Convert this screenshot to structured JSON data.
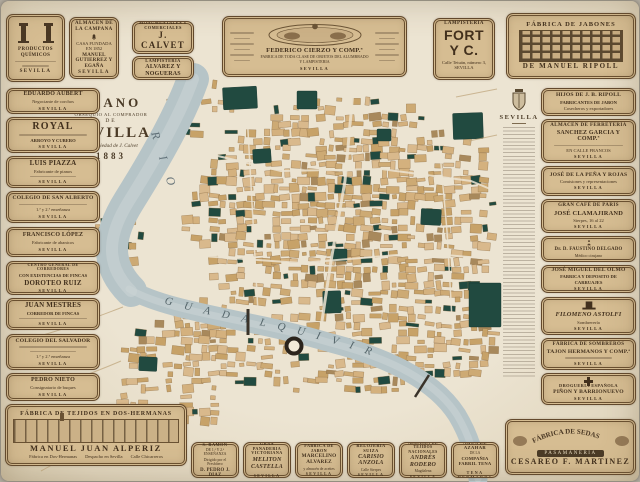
{
  "palette": {
    "paper": "#ece4d2",
    "ad_bg": "#d6bd92",
    "ad_border": "#63492c",
    "ink": "#42301d",
    "river": "#b6c4c7",
    "block_tan": "#d3b07d",
    "landmark_green": "#214a40"
  },
  "title_block": {
    "kicker": "PLANO",
    "dedication": "OBSEQUIO AL COMPRADOR",
    "de": "DE",
    "city": "SEVILLA",
    "property": "Es propiedad de J. Calvet",
    "year": "1883"
  },
  "map_labels": {
    "rio": "RIO",
    "river": "GUADALQUIVIR"
  },
  "strip": {
    "heading": "SEVILLA"
  },
  "top_ads": [
    {
      "header": "PRODUCTOS QUÍMICOS",
      "city": "SEVILLA"
    },
    {
      "header": "ALMACEN DE LA CAMPANA",
      "line": "CASA FUNDADA EN 1852",
      "name": "MANUEL GUTIERREZ Y EGAÑA",
      "city": "SEVILLA"
    },
    {
      "header": "PLANOS MONUMENTALES Y COMERCIALES",
      "name": "J. CALVET",
      "city": "BARCELONA"
    },
    {
      "header": "TALLER DE LAMPISTERIA",
      "name": "ALVAREZ Y NOGUERAS",
      "line": "Calle de Gallegos",
      "city": "SEVILLA"
    },
    {
      "name": "FEDERICO CIERZO Y COMP.ª",
      "sub": "FABRICA DE TODA CLASE DE OBJETOS DEL ALUMBRADO Y LAMPISTERIA",
      "city": "SEVILLA"
    },
    {
      "header": "LAMPISTERIA",
      "name": "FORT Y C.",
      "line": "Calle Tetuán, número 3, SEVILLA"
    },
    {
      "header": "FÁBRICA DE JABONES",
      "name": "DE MANUEL RIPOLL",
      "city": "SEVILLA"
    }
  ],
  "left_ads": [
    {
      "name": "EDUARDO AUBERT",
      "line": "Negociante de corchos",
      "city": "SEVILLA"
    },
    {
      "name": "ROYAL",
      "line": "ARROYO Y CUBERO",
      "city": "SEVILLA"
    },
    {
      "name": "LUIS PIAZZA",
      "line": "Fabricante de pianos",
      "city": "SEVILLA"
    },
    {
      "name": "COLEGIO DE SAN ALBERTO",
      "line": "1.ª y 2.ª enseñanza",
      "city": "SEVILLA"
    },
    {
      "name": "FRANCISCO LÓPEZ",
      "line": "Fabricante de abanicos",
      "city": "SEVILLA"
    },
    {
      "header": "CENTRO GENERAL DE CORREDORES",
      "sub": "CON EXISTENCIAS DE FINCAS",
      "name": "DOROTEO RUIZ",
      "city": "SEVILLA"
    },
    {
      "name": "JUAN MESTRES",
      "sub": "CORREDOR DE FINCAS",
      "city": "SEVILLA"
    },
    {
      "name": "COLEGIO DEL SALVADOR",
      "line": "1.ª y 2.ª enseñanza",
      "city": "SEVILLA"
    },
    {
      "name": "PEDRO NIETO",
      "line": "Consignatario de buques",
      "city": "SEVILLA"
    }
  ],
  "tejidos_ad": {
    "header": "FÁBRICA DE TEJIDOS EN DOS-HERMANAS",
    "name": "MANUEL JUAN ALPERIZ",
    "foot_left": "Fábrica en Dos-Hermanas",
    "foot_center": "Despacho en Sevilla",
    "foot_right": "Calle Chicarreros"
  },
  "right_ads": [
    {
      "name": "HIJOS DE J. B. RIPOLL",
      "sub": "FABRICANTES DE JABON",
      "line": "Cosecheros y exportadores",
      "city": "SEVILLA"
    },
    {
      "header": "ALMACEN DE FERRETERIA",
      "name": "SANCHEZ GARCIA Y COMP.ª",
      "line": "EN CALLE FRANCOS",
      "city": "SEVILLA"
    },
    {
      "name": "JOSÉ DE LA PEÑA Y ROJAS",
      "line": "Comisiones y representaciones",
      "city": "SEVILLA"
    },
    {
      "header": "GRAN CAFÉ DE PARIS",
      "name": "JOSÉ CLAMAJIRAND",
      "line": "Sierpes, 16 al 22",
      "city": "SEVILLA"
    },
    {
      "name": "Dr. D. FAUSTINO DELGADO",
      "line": "Médico cirujano",
      "city": "SEVILLA"
    },
    {
      "name": "JOSÉ MIGUEL DEL OLMO",
      "sub": "FABRICA Y DEPOSITO DE CARRUAJES",
      "city": "SEVILLA"
    },
    {
      "name": "FILOMENO ASTOLFI",
      "line": "Sombrerería",
      "city": "SEVILLA"
    },
    {
      "header": "FÁBRICA DE SOMBREROS",
      "name": "TAJON HERMANOS Y COMP.ª",
      "city": "SEVILLA"
    },
    {
      "header": "DROGUERIA ESPAÑOLA",
      "name": "PIÑON Y BARRIONUEVO",
      "city": "SEVILLA"
    }
  ],
  "bottom_ads": [
    {
      "header": "COLEGIO DE S. RAMON",
      "line": "DE 1.ª Y 2.ª ENSEÑANZA",
      "line2": "Dirigido por el Presbítero",
      "name": "D. PEDRO J. DIAZ",
      "city": "SEVILLA"
    },
    {
      "header": "GRAN PANADERIA VICTORIANA",
      "name": "MELITON CASTELLA",
      "city": "SEVILLA"
    },
    {
      "header": "FABRICA DE JABON",
      "name": "MARCELINO ALVAREZ",
      "line": "y almacén de aceites",
      "city": "SEVILLA"
    },
    {
      "header": "RELOJERIA SUIZA",
      "name": "CARISIO ANZOLA",
      "line": "Calle Sierpes",
      "city": "SEVILLA"
    },
    {
      "header": "ALMACEN DE TEJIDOS NACIONALES",
      "name": "ANDRÉS RODERO",
      "line": "Magdalena",
      "city": "SEVILLA"
    },
    {
      "header": "AGUA DE AZAHAR",
      "line": "DE LA",
      "name": "COMPAÑIA FABRIL TENA",
      "foot": "TENA HERMANOS"
    }
  ],
  "cesareo_ad": {
    "arc": "FÁBRICA DE SEDAS",
    "banner": "PASAMANERIA",
    "name": "CESAREO F. MARTINEZ"
  }
}
